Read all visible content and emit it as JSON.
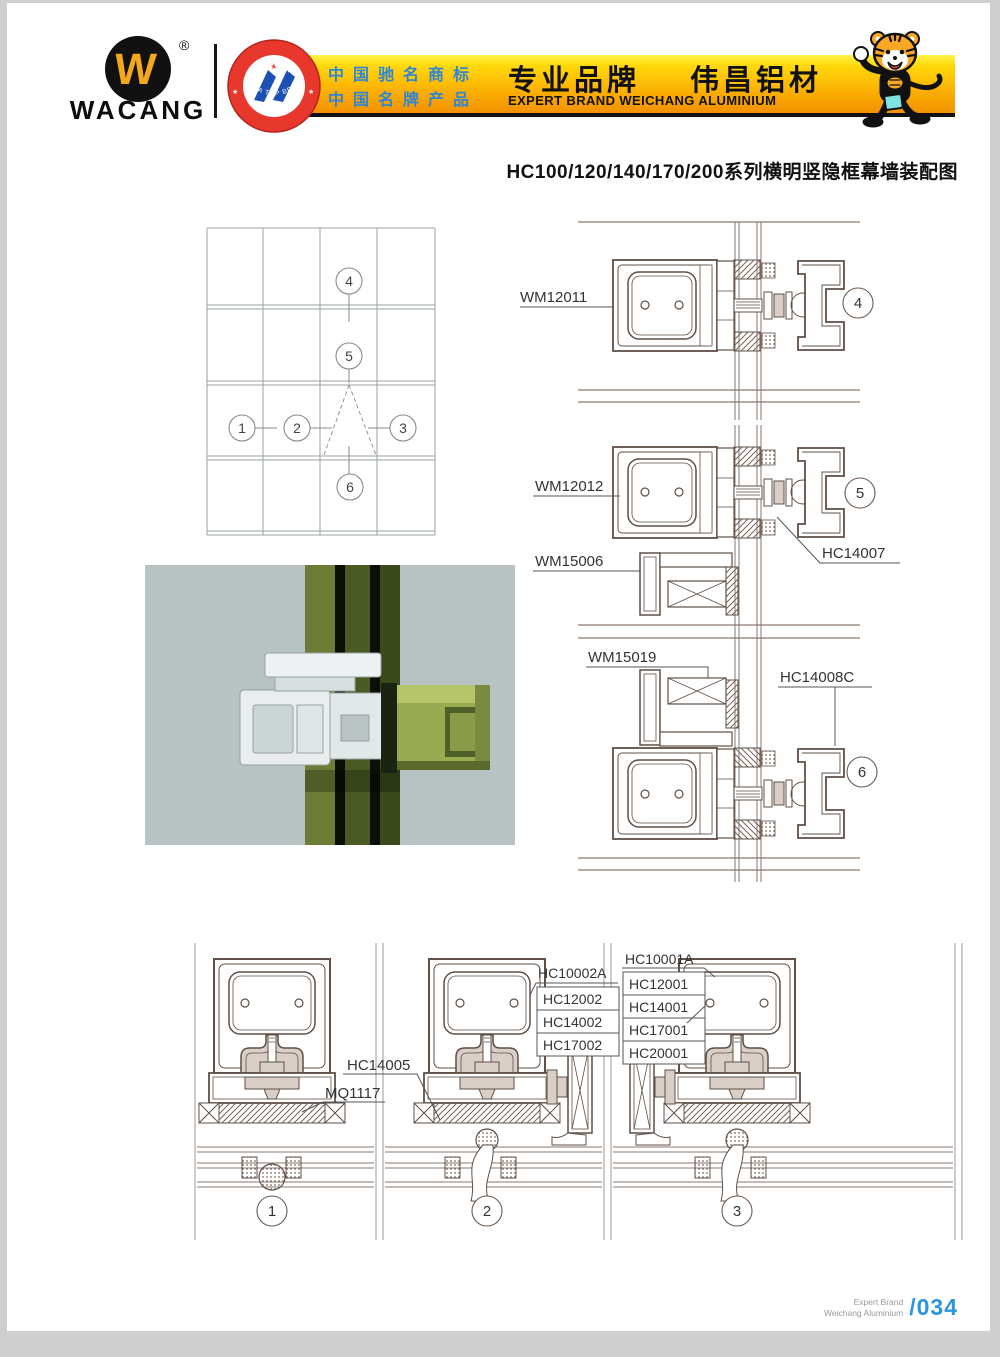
{
  "header": {
    "brand": "WACANG",
    "registered": "®",
    "logo_w": "W",
    "badge_top": "中国名牌",
    "badge_bottom": "CHINA TOP BRAND",
    "banner_line1": "中国驰名商标",
    "banner_line2": "中国名牌产品",
    "banner_title_left": "专业品牌",
    "banner_title_right": "伟昌铝材",
    "banner_subtitle": "EXPERT BRAND WEICHANG ALUMINIUM"
  },
  "doc_title": "HC100/120/140/170/200系列横明竖隐框幕墙装配图",
  "overview": {
    "c1": "1",
    "c2": "2",
    "c3": "3",
    "c4": "4",
    "c5": "5",
    "c6": "6"
  },
  "details_right": {
    "d4": {
      "callout": "4",
      "wm12011": "WM12011"
    },
    "d5": {
      "callout": "5",
      "wm12012": "WM12012",
      "wm15006": "WM15006",
      "hc14007": "HC14007"
    },
    "d6": {
      "callout": "6",
      "wm15019": "WM15019",
      "hc14008c": "HC14008C"
    }
  },
  "details_bottom": {
    "d1": {
      "callout": "1",
      "mq1117": "MQ1117"
    },
    "d2": {
      "callout": "2",
      "hc14005": "HC14005",
      "stack": [
        "HC10002A",
        "HC12002",
        "HC14002",
        "HC17002"
      ]
    },
    "d3": {
      "callout": "3",
      "stack": [
        "HC10001A",
        "HC12001",
        "HC14001",
        "HC17001",
        "HC20001"
      ]
    }
  },
  "footer": {
    "expert_line1": "Expert Brand",
    "expert_line2": "Weichang Aluminium",
    "page_number": "/034"
  },
  "colors": {
    "banner_yellow": "#ffd90a",
    "banner_orange": "#f29100",
    "banner_blue_text": "#2e86d6",
    "badge_red": "#e8372c",
    "logo_gold": "#f3a71c",
    "page_number_blue": "#2a97dc",
    "drawing_line": "#5f4f45"
  }
}
